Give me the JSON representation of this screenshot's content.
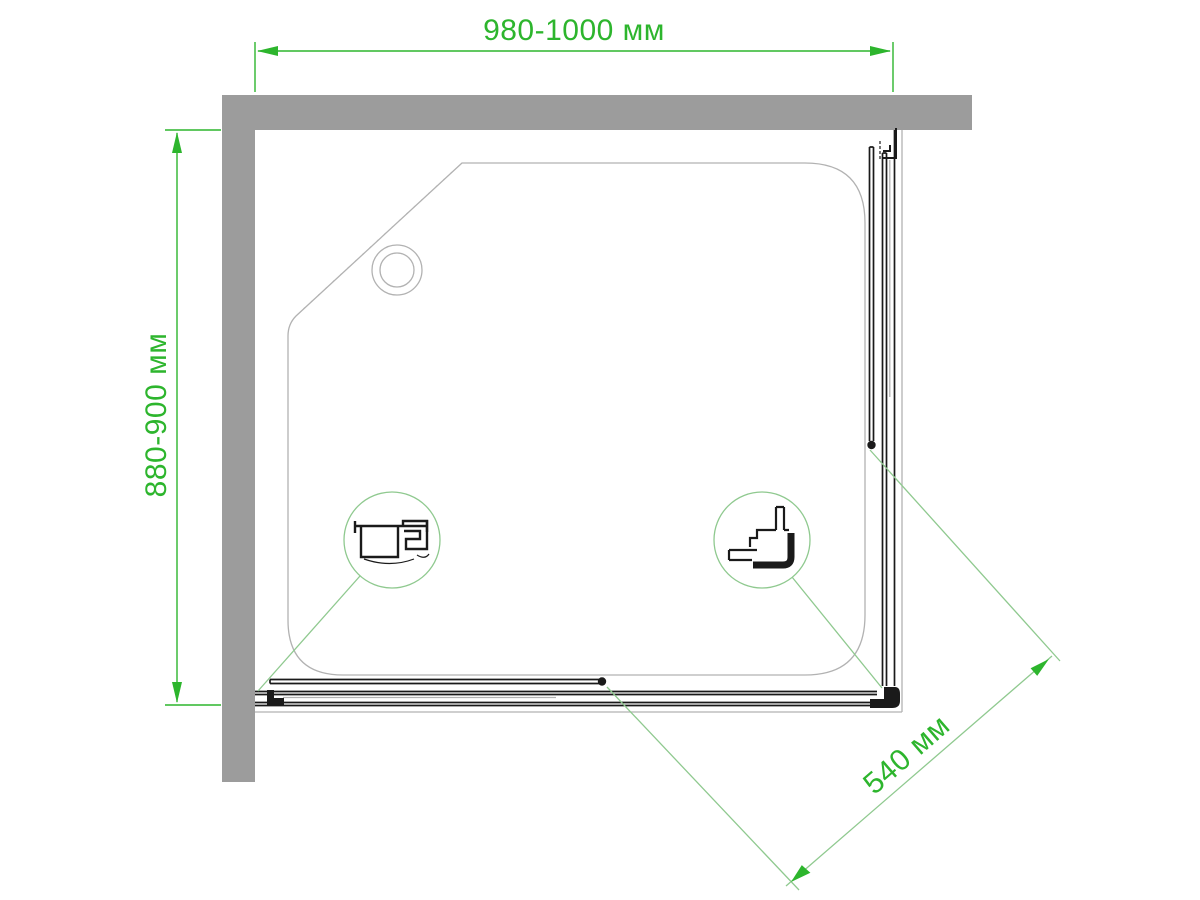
{
  "drawing": {
    "type": "shower-enclosure-top-view-technical-drawing",
    "dimensions": {
      "width_label": "980-1000 мм",
      "depth_label": "880-900 мм",
      "door_opening_label": "540 мм"
    }
  },
  "colors": {
    "background": "#ffffff",
    "wall_gray": "#9c9c9c",
    "tray_gray": "#b2b2b2",
    "glass_gray": "#a0a0a0",
    "line_black": "#1a1a1a",
    "dim_green": "#2db52d",
    "leader_green": "#8fc98f"
  }
}
